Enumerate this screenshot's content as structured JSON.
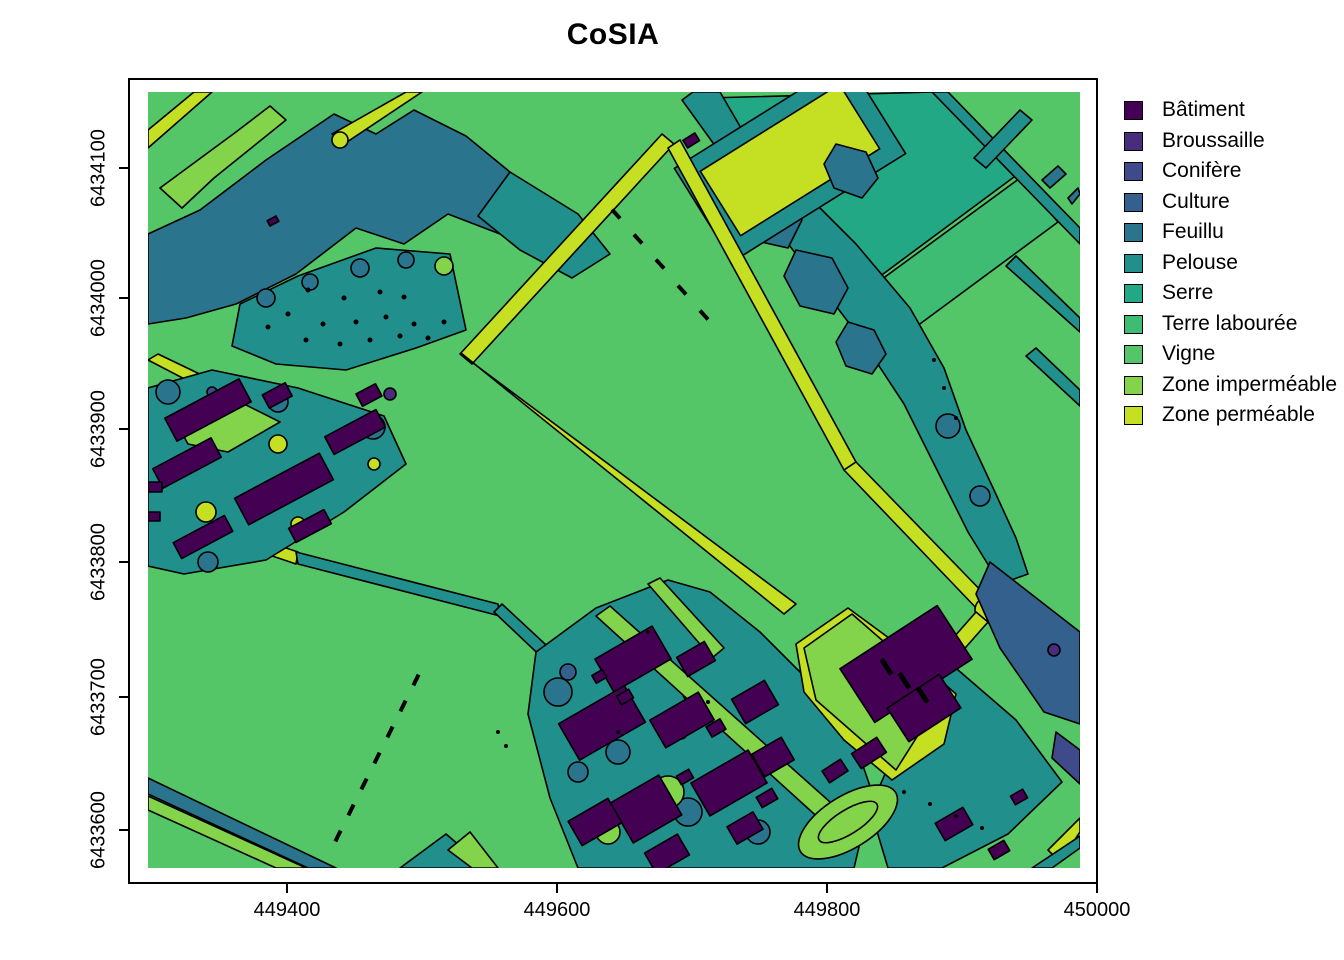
{
  "title": "CoSIA",
  "axes": {
    "x": {
      "ticks": [
        "449400",
        "449600",
        "449800",
        "450000"
      ]
    },
    "y": {
      "ticks": [
        "6434100",
        "6434000",
        "6433900",
        "6433800",
        "6433700",
        "6433600"
      ]
    }
  },
  "legend": {
    "items": [
      {
        "key": "batiment",
        "label": "Bâtiment",
        "color": "#440154"
      },
      {
        "key": "broussaille",
        "label": "Broussaille",
        "color": "#472D7B"
      },
      {
        "key": "conifere",
        "label": "Conifère",
        "color": "#3E4A89"
      },
      {
        "key": "culture",
        "label": "Culture",
        "color": "#34608D"
      },
      {
        "key": "feuillu",
        "label": "Feuillu",
        "color": "#2B748E"
      },
      {
        "key": "pelouse",
        "label": "Pelouse",
        "color": "#21908C"
      },
      {
        "key": "serre",
        "label": "Serre",
        "color": "#22A884"
      },
      {
        "key": "terre_labouree",
        "label": "Terre labourée",
        "color": "#3FBC73"
      },
      {
        "key": "vigne",
        "label": "Vigne",
        "color": "#55C667"
      },
      {
        "key": "zone_impermeable",
        "label": "Zone imperméable",
        "color": "#84D44B"
      },
      {
        "key": "zone_permeable",
        "label": "Zone perméable",
        "color": "#C5DF23"
      }
    ]
  },
  "map_outline_color": "#000000"
}
